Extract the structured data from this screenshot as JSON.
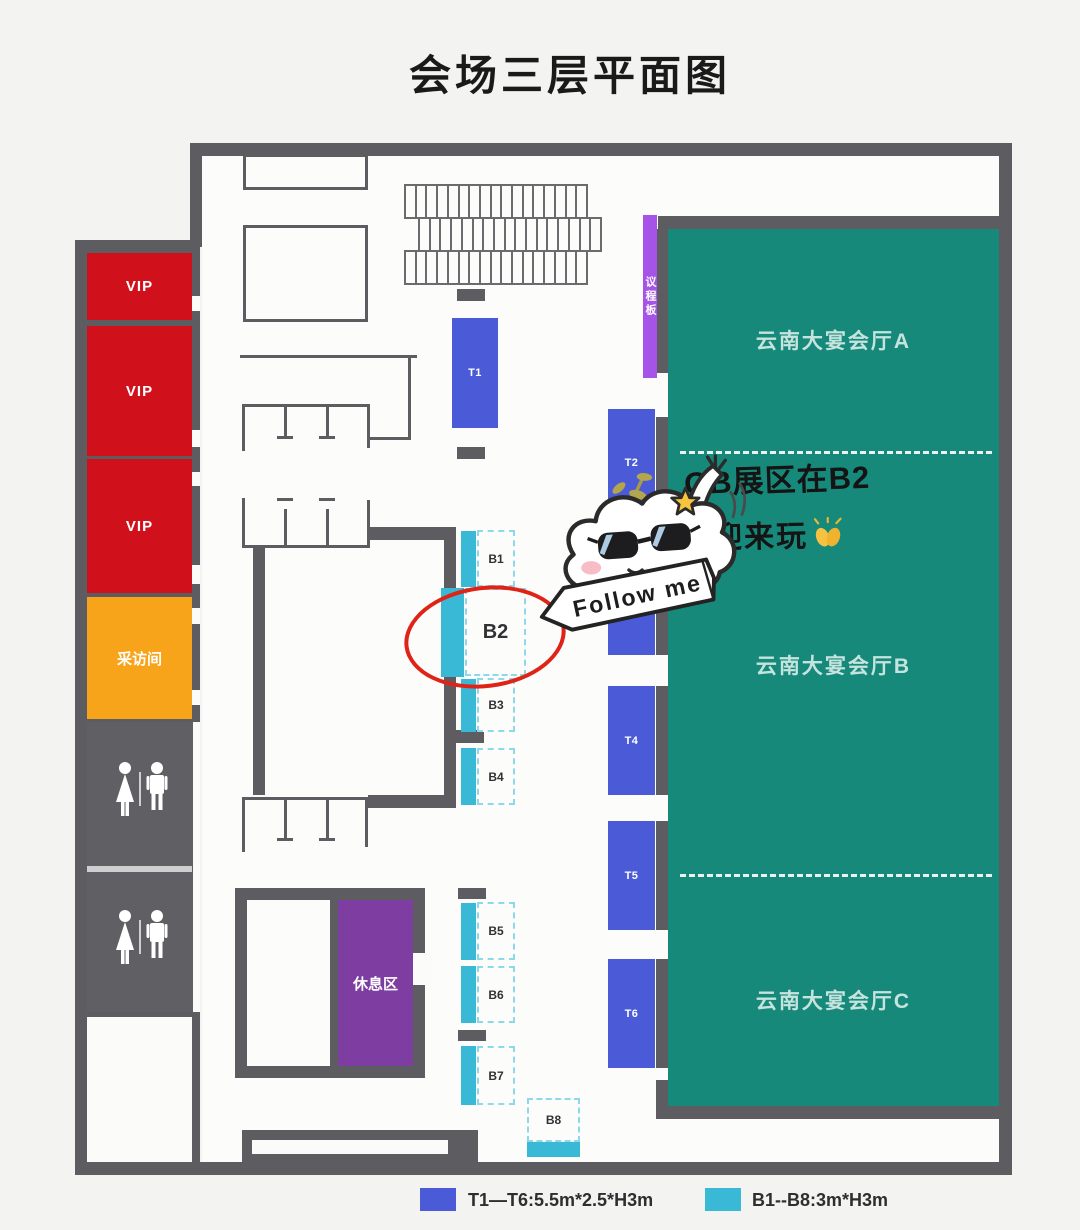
{
  "title": "会场三层平面图",
  "left_wing": {
    "vip_rooms": [
      {
        "label": "VIP"
      },
      {
        "label": "VIP"
      },
      {
        "label": "VIP"
      }
    ],
    "interview_room": {
      "label": "采访间"
    }
  },
  "agenda_board": {
    "label": "议程板"
  },
  "rest_area": {
    "label": "休息区"
  },
  "halls": [
    {
      "label": "云南大宴会厅A"
    },
    {
      "label": "云南大宴会厅B"
    },
    {
      "label": "云南大宴会厅C"
    }
  ],
  "t_booths": [
    {
      "label": "T1"
    },
    {
      "label": "T2"
    },
    {
      "label": ""
    },
    {
      "label": "T4"
    },
    {
      "label": "T5"
    },
    {
      "label": "T6"
    }
  ],
  "b_booths": [
    {
      "label": "B1"
    },
    {
      "label": "B2"
    },
    {
      "label": "B3"
    },
    {
      "label": "B4"
    },
    {
      "label": "B5"
    },
    {
      "label": "B6"
    },
    {
      "label": "B7"
    },
    {
      "label": "B8"
    }
  ],
  "seating_rows": [
    17,
    17,
    17
  ],
  "annotations": {
    "note_line1": "OB展区在B2",
    "note_line2": "欢迎来玩",
    "banner": "Follow me"
  },
  "legend": [
    {
      "color": "#4b5bd7",
      "label": "T1—T6:5.5m*2.5*H3m"
    },
    {
      "color": "#3ab9d6",
      "label": "B1--B8:3m*H3m"
    }
  ],
  "colors": {
    "wall": "#5d5d61",
    "vip_red": "#d0111b",
    "interview_orange": "#f7a41b",
    "booth_blue": "#4b5bd7",
    "booth_cyan": "#3ab9d6",
    "hall_teal": "#17897b",
    "rest_purple": "#7e3da1",
    "agenda_violet": "#a653e8",
    "annotation_red": "#e02317"
  }
}
